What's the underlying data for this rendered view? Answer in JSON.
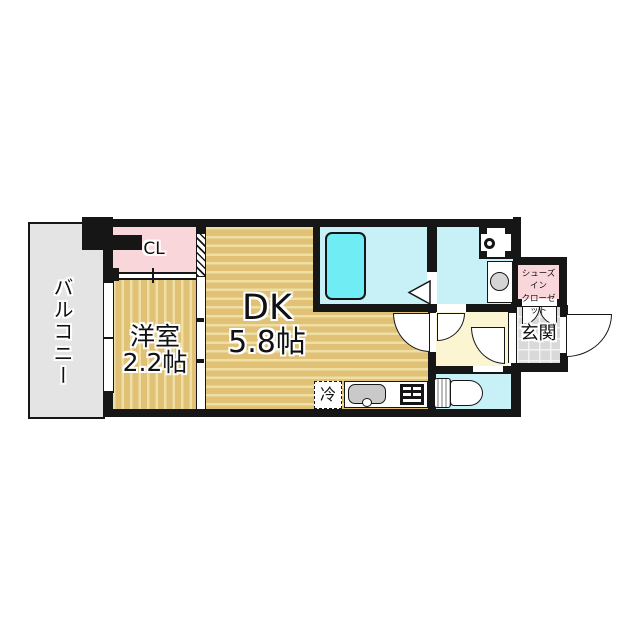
{
  "floorplan": {
    "balcony": {
      "label": "バルコニー"
    },
    "closet": {
      "label": "CL"
    },
    "western_room": {
      "label": "洋室",
      "size": "2.2帖"
    },
    "dining_kitchen": {
      "label": "DK",
      "size": "5.8帖"
    },
    "refrigerator": {
      "label": "冷"
    },
    "shoes_closet": {
      "label_line1": "シューズイン",
      "label_line2": "クローゼット"
    },
    "entrance": {
      "label": "玄関"
    },
    "colors": {
      "wall_black": "#161616",
      "floor_tan": "#e0c176",
      "floor_stripe_light": "#eedfa4",
      "closet_pink": "#f9d6da",
      "wet_area_cyan": "#c7f0f7",
      "bathtub_cyan": "#70edf4",
      "hallway_yellow": "#fbf5d2",
      "balcony_gray": "#e4e4e4",
      "entrance_tile_gray": "#d9d9d9"
    }
  }
}
